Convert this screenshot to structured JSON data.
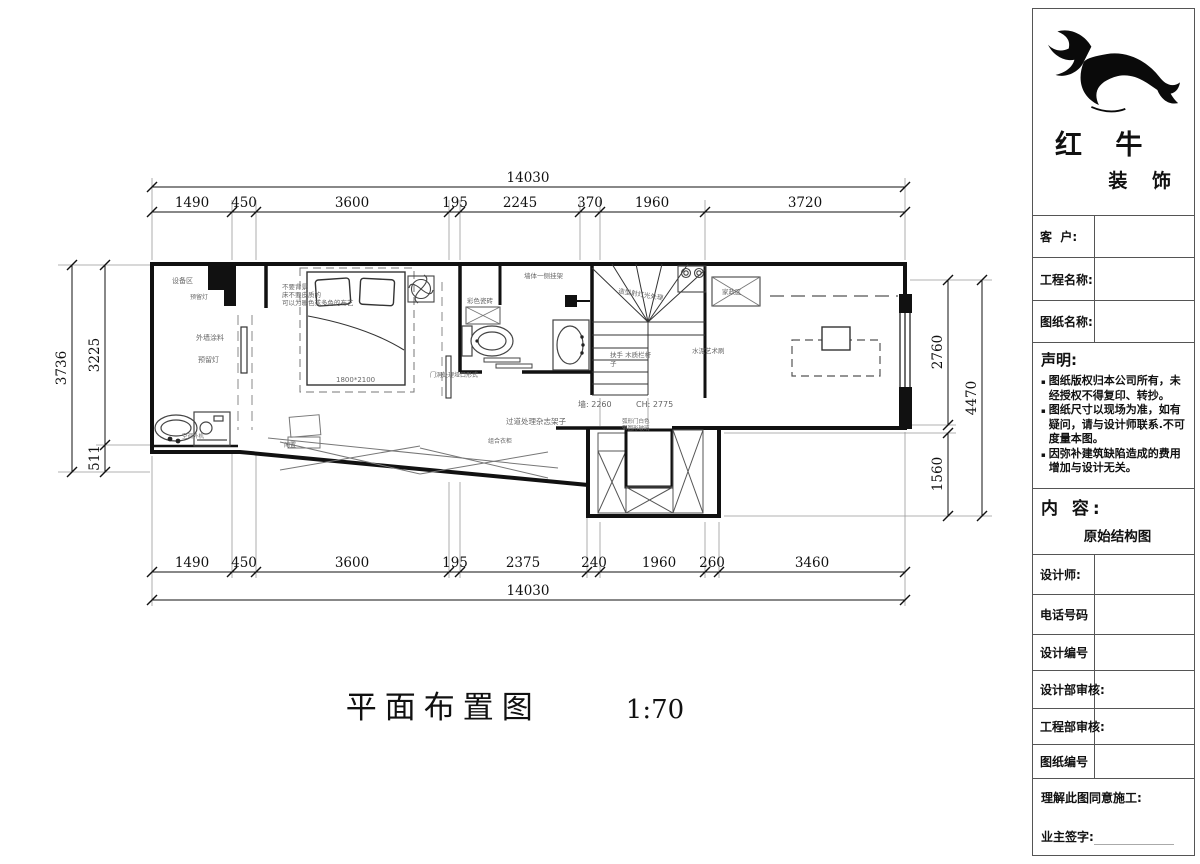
{
  "plan": {
    "title": "平面布置图",
    "scale": "1:70",
    "dims": {
      "top_total": "14030",
      "top_segments": [
        "1490",
        "450",
        "3600",
        "195",
        "2245",
        "370",
        "1960",
        "3720"
      ],
      "bottom_segments": [
        "1490",
        "450",
        "3600",
        "195",
        "2375",
        "240",
        "1960",
        "260",
        "3460"
      ],
      "bottom_total": "14030",
      "left_total": "3736",
      "left_upper": "3225",
      "left_lower": "511",
      "right_upper": "2760",
      "right_lower": "1560",
      "right_total": "4470"
    },
    "labels": {
      "equipment_area": "设备区",
      "reserved_light_top": "预留灯",
      "exterior_paint": "外墙涂料",
      "reserved_light": "预留灯",
      "ac_outdoor_unit": "空调外机",
      "bed_note_line1": "不要背景",
      "bed_note_line2": "床不要皮质的",
      "bed_note_line3": "可以为暖色或多色的布艺",
      "bed_size": "1800*2100",
      "idle": "闲置",
      "wardrobe": "组合衣柜",
      "door_note": "门洞处理垭口形式",
      "tile_note": "彩色瓷砖",
      "wall_rack_note": "墙体一侧挂架",
      "stair_light_note": "造型射灯光处理",
      "housekeeping_area": "家政区",
      "handrail_note_line1": "扶手 木质栏杆",
      "handrail_note_line2": "子",
      "cement_art_note": "水泥艺术刷",
      "wall_height": "墙: 2260",
      "ceiling_height": "CH: 2775",
      "corridor_note": "过道处理杂志架子",
      "arc_door_line1": "弧形门白色",
      "arc_door_line2": "带圆形玻璃"
    }
  },
  "titleblock": {
    "brand_name": "红 牛",
    "brand_suffix": "装 饰",
    "fields": {
      "customer": "客  户:",
      "project_name": "工程名称:",
      "drawing_name": "图纸名称:",
      "designer": "设计师:",
      "phone": "电话号码",
      "design_no": "设计编号",
      "design_dept_review": "设计部审核:",
      "eng_dept_review": "工程部审核:",
      "drawing_no": "图纸编号"
    },
    "statement": {
      "title": "声明:",
      "bullet": "▪",
      "items": [
        "图纸版权归本公司所有，未经授权不得复印、转抄。",
        "图纸尺寸以现场为准，如有疑问，请与设计师联系.不可度量本图。",
        "因弥补建筑缺陷造成的费用增加与设计无关。"
      ]
    },
    "content": {
      "title": "内 容:",
      "value": "原始结构图"
    },
    "footer": {
      "agree": "理解此图同意施工:",
      "owner_sign": "业主签字:"
    }
  },
  "colors": {
    "line": "#1a1a1a",
    "annotation": "#666666",
    "border": "#555555"
  }
}
